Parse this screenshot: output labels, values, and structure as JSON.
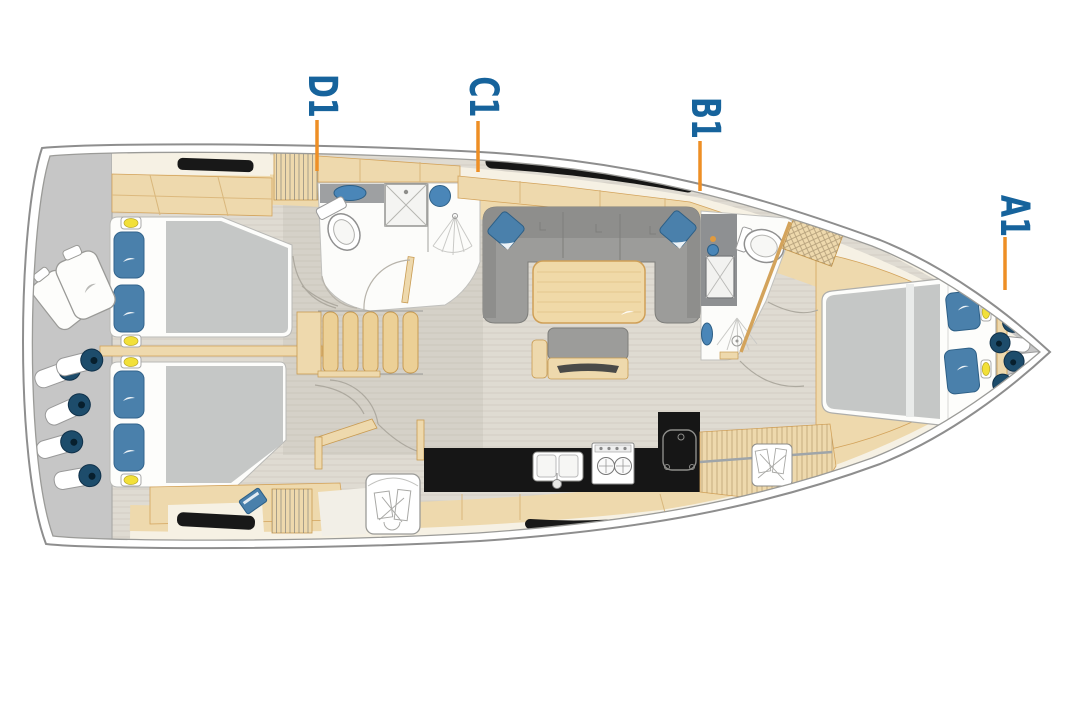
{
  "diagram": {
    "type": "yacht-interior-floor-plan",
    "orientation": "bow-right",
    "cabin_labels": [
      {
        "id": "D1",
        "text": "D1"
      },
      {
        "id": "C1",
        "text": "C1"
      },
      {
        "id": "B1",
        "text": "B1"
      },
      {
        "id": "A1",
        "text": "A1"
      }
    ],
    "icons": {
      "toilet": "toilet-icon",
      "sink": "sink-icon",
      "shower": "shower-spray-icon",
      "stove": "stove-burner-icon",
      "fender": "fender-roll-icon",
      "stairs": "companionway-stairs-icon"
    },
    "colors": {
      "label_blue": "#16639C",
      "leader_orange": "#EE8F25",
      "hull_outline_gray": "#8E8E8E",
      "stern_gray": "#C6C6C6",
      "floor_greige": "#DFDBD2",
      "deck_cream": "#F6F1E4",
      "wood_light": "#EED9AD",
      "wood_edge": "#C89B52",
      "window_black": "#181818",
      "sofa_gray": "#9C9C9A",
      "mattress_gray": "#C5C7C6",
      "cushion_blue": "#4A80AB",
      "fender_navy": "#1D4C6B",
      "reading_light_yellow": "#F2E038"
    }
  }
}
